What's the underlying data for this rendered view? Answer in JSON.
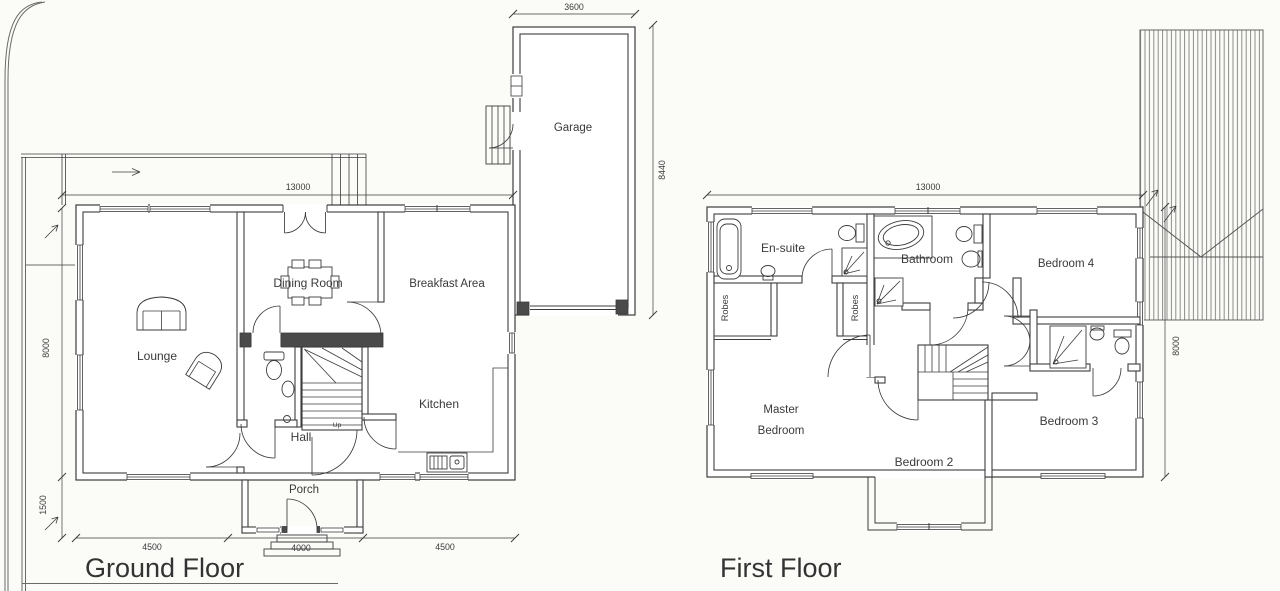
{
  "ground_floor": {
    "title": "Ground Floor",
    "rooms": {
      "lounge": "Lounge",
      "dining_room": "Dining Room",
      "breakfast_area": "Breakfast Area",
      "kitchen": "Kitchen",
      "hall": "Hall",
      "porch": "Porch",
      "garage": "Garage"
    },
    "stairs": {
      "direction_label": "Up"
    },
    "dimensions": {
      "overall_width": "13000",
      "overall_depth": "8000",
      "rear_offset": "1500",
      "front_left": "4500",
      "front_centre": "4000",
      "front_right": "4500",
      "garage_width": "3600",
      "garage_depth": "8440"
    }
  },
  "first_floor": {
    "title": "First Floor",
    "rooms": {
      "master_bedroom_line1": "Master",
      "master_bedroom_line2": "Bedroom",
      "bedroom_2": "Bedroom 2",
      "bedroom_3": "Bedroom 3",
      "bedroom_4": "Bedroom 4",
      "en_suite": "En-suite",
      "bathroom": "Bathroom",
      "robes_left": "Robes",
      "robes_right": "Robes"
    },
    "dimensions": {
      "overall_width": "13000",
      "overall_depth": "8000"
    }
  }
}
